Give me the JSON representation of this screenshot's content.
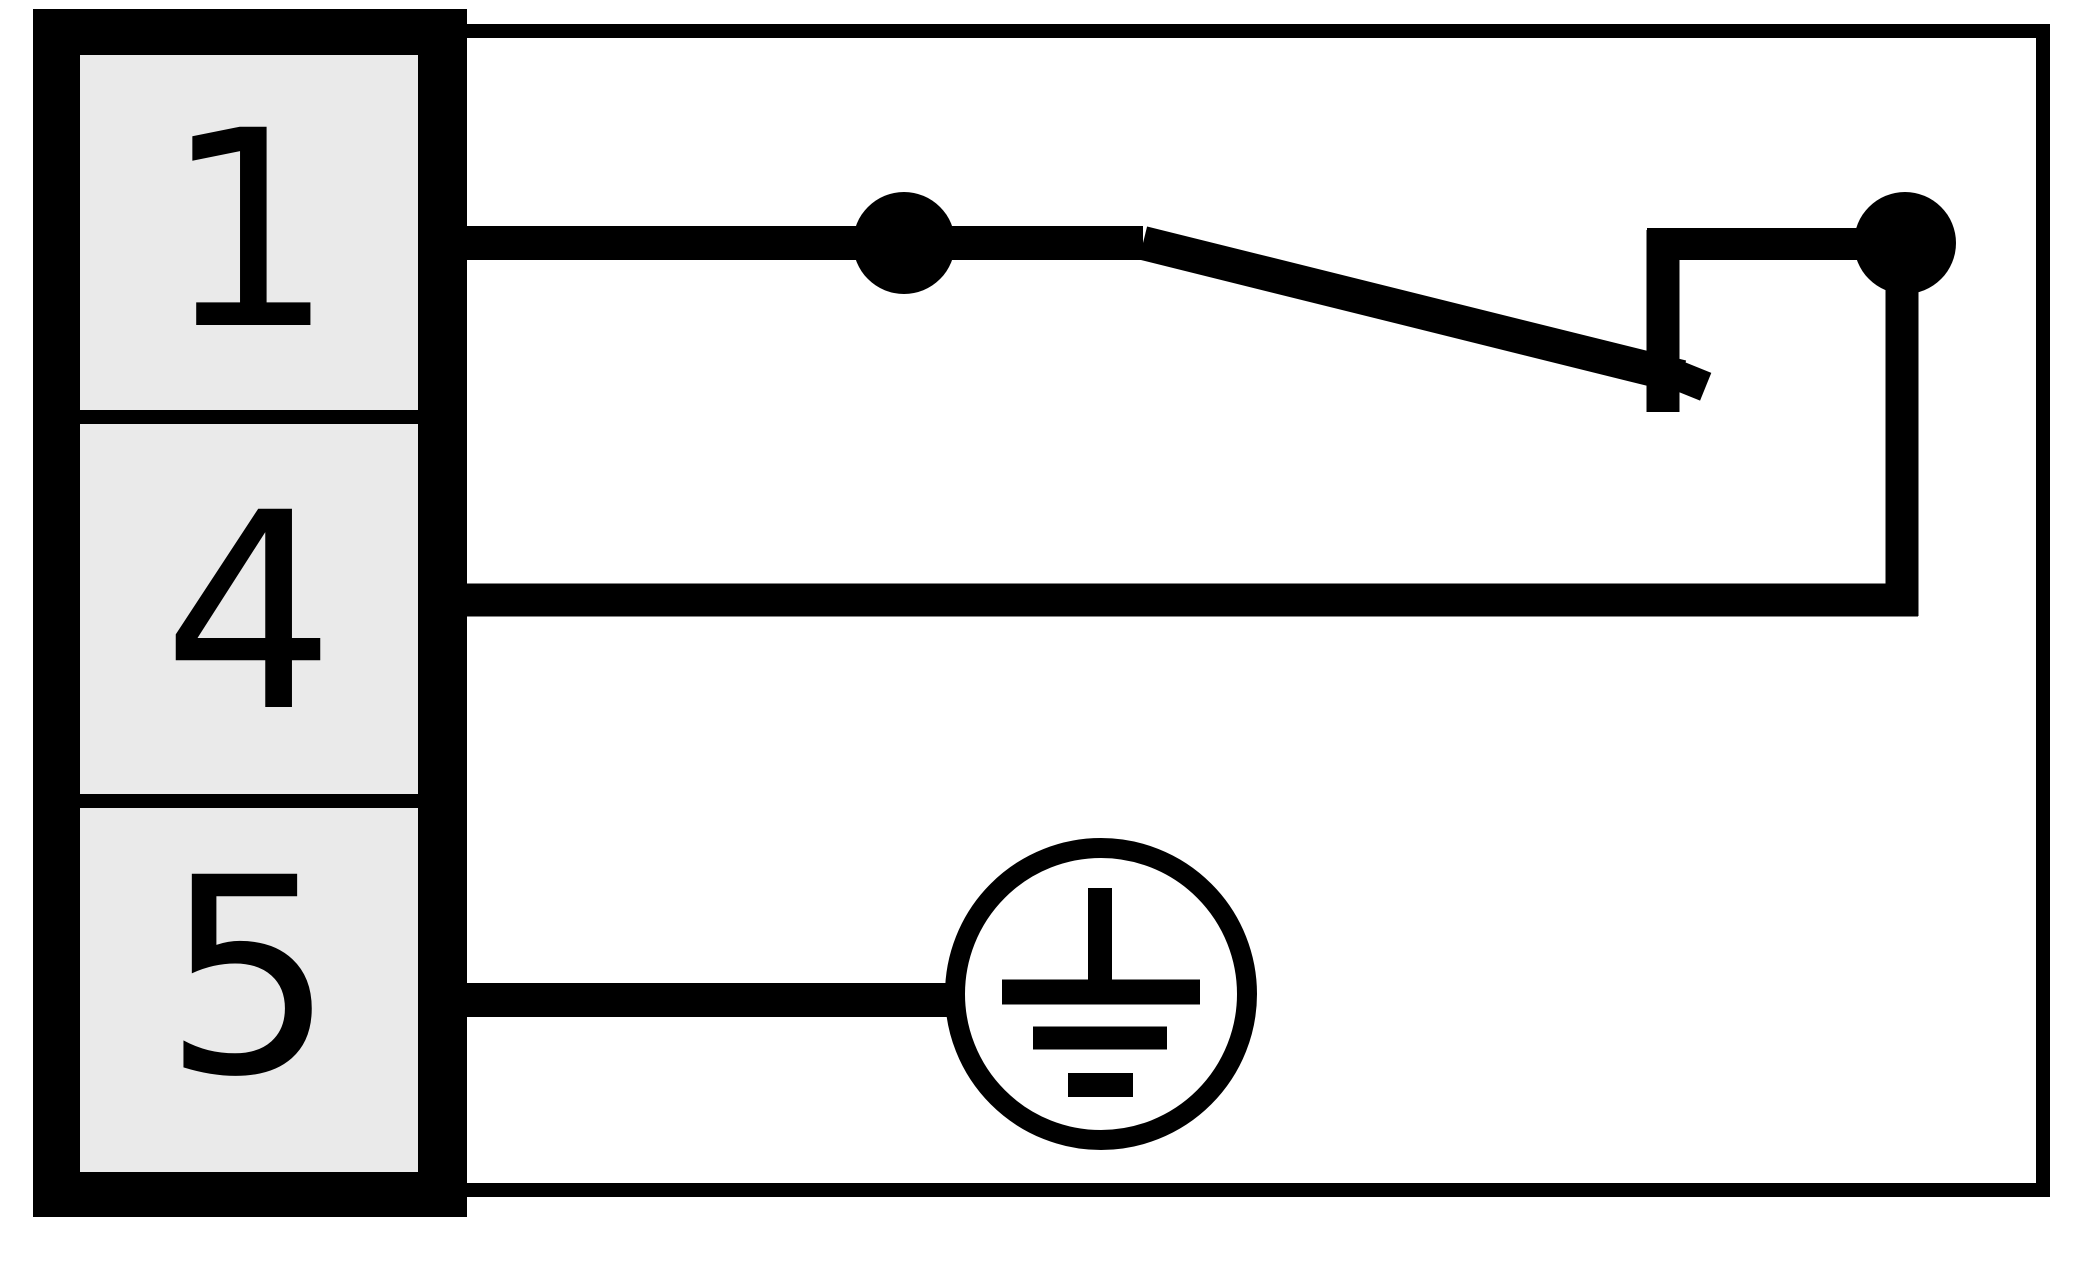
{
  "diagram": {
    "kind": "sensor-connector-wiring-diagram",
    "terminal_block": {
      "terminals": [
        {
          "pin": "1"
        },
        {
          "pin": "4"
        },
        {
          "pin": "5"
        }
      ]
    },
    "symbols": {
      "switch_contact": "nc-switch-contact-between-pin1-and-pin4",
      "ground": "protective-earth-ground-on-pin5"
    },
    "colors": {
      "line": "#000000",
      "terminal_fill": "#eaeaea",
      "background": "#ffffff"
    }
  }
}
